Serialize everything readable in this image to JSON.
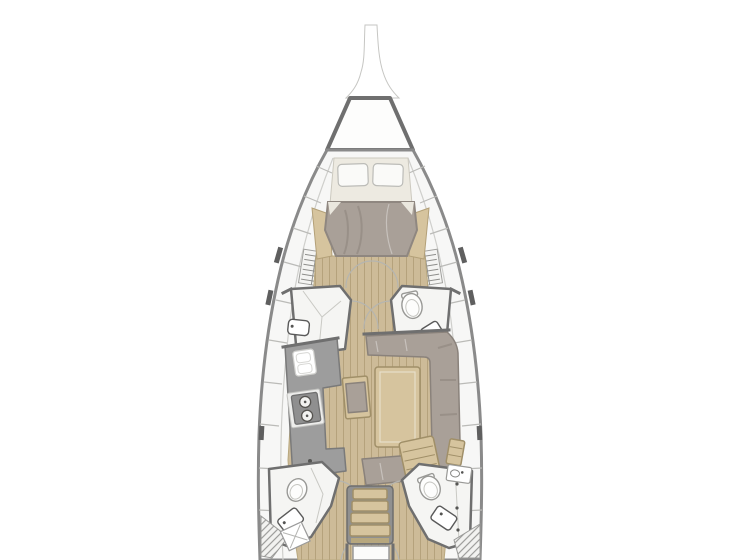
{
  "diagram": {
    "type": "floor-plan",
    "subject": "sailboat-interior-top-view",
    "layout": {
      "bow": {
        "bowsprit": 1,
        "anchor_locker": 1
      },
      "forward_cabin": {
        "double_berth": 1,
        "pillows": 2,
        "side_shelves": 2,
        "louvered_vents": 2
      },
      "midship": {
        "port_compartment": {
          "sink": 1
        },
        "starboard_head": {
          "toilet": 1,
          "sink": 1
        }
      },
      "galley_port": {
        "sink_unit": 1,
        "stove_burners": 2,
        "chart_desk": 1
      },
      "salon_starboard": {
        "settee_shape": "U",
        "table": 1,
        "bench_seat": 1,
        "slatted_bench": 1
      },
      "aft": {
        "port_head": {
          "toilet": 1,
          "sink": 1
        },
        "starboard_head": {
          "toilet": 1,
          "sink": 1,
          "vanity_basin": 1
        },
        "companionway_steps": 4
      },
      "door_swing_arcs": 8,
      "hull_windows_per_side": 4,
      "hatched_corner_steps": 2
    }
  },
  "palette": {
    "bg": "#ffffff",
    "hull_stroke": "#8a8a8a",
    "wall": "#6f6f6f",
    "deck": "#f7f7f6",
    "floor_wood": "#cdbb98",
    "plank_line": "#b5a27c",
    "furniture_wood": "#d6c49e",
    "wood_border": "#a08f68",
    "cushion": "#a9a098",
    "cushion_line": "#8a827b",
    "mattress": "#edeae1",
    "pillow": "#fafaf8",
    "counter": "#9d9d9d",
    "counter_border": "#7a7a7a",
    "stove": "#8f8f8f",
    "fixture_stroke": "#5a5a5a",
    "white_fixture": "#f5f5f3",
    "window_glass": "#5f5f5f",
    "arc": "#b5b5b0"
  }
}
